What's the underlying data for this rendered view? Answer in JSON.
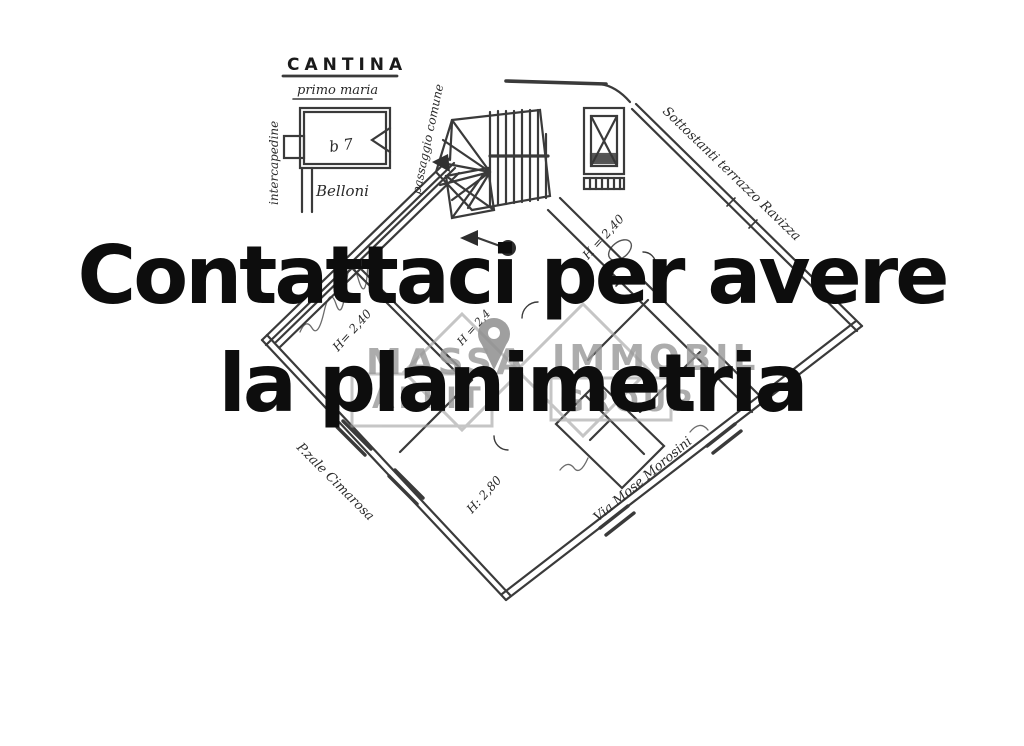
{
  "overlay": {
    "line1": "Contattaci per avere",
    "line2": "la planimetria",
    "text_color": "#0d0d0d"
  },
  "watermark": {
    "brand_top_left": "MASSA",
    "brand_top_right": "IMMOBIL",
    "brand_bottom_left": "AFFIT",
    "brand_bottom_right": "GROUP",
    "color": "#9a9a9a",
    "icons": [
      "location-pin-icon",
      "house-outline-icon"
    ]
  },
  "floorplan": {
    "cantina": {
      "title": "CANTINA",
      "subtitle": "primo maria",
      "left_label": "intercapedine",
      "right_label": "passaggio comune",
      "bottom_label": "Belloni",
      "inner_label": "b 7"
    },
    "annotations": {
      "top_right_wall": "Sottostanti terrazzo Ravizza",
      "bottom_left_street": "P.zale Cimarosa",
      "bottom_right_street": "Via Mose Morosini",
      "height_left": "H= 2,40",
      "height_top": "H = 2,40",
      "height_center": "H = 2,4",
      "height_bottom": "H: 2,80"
    },
    "line_color": "#1f1f1f"
  }
}
